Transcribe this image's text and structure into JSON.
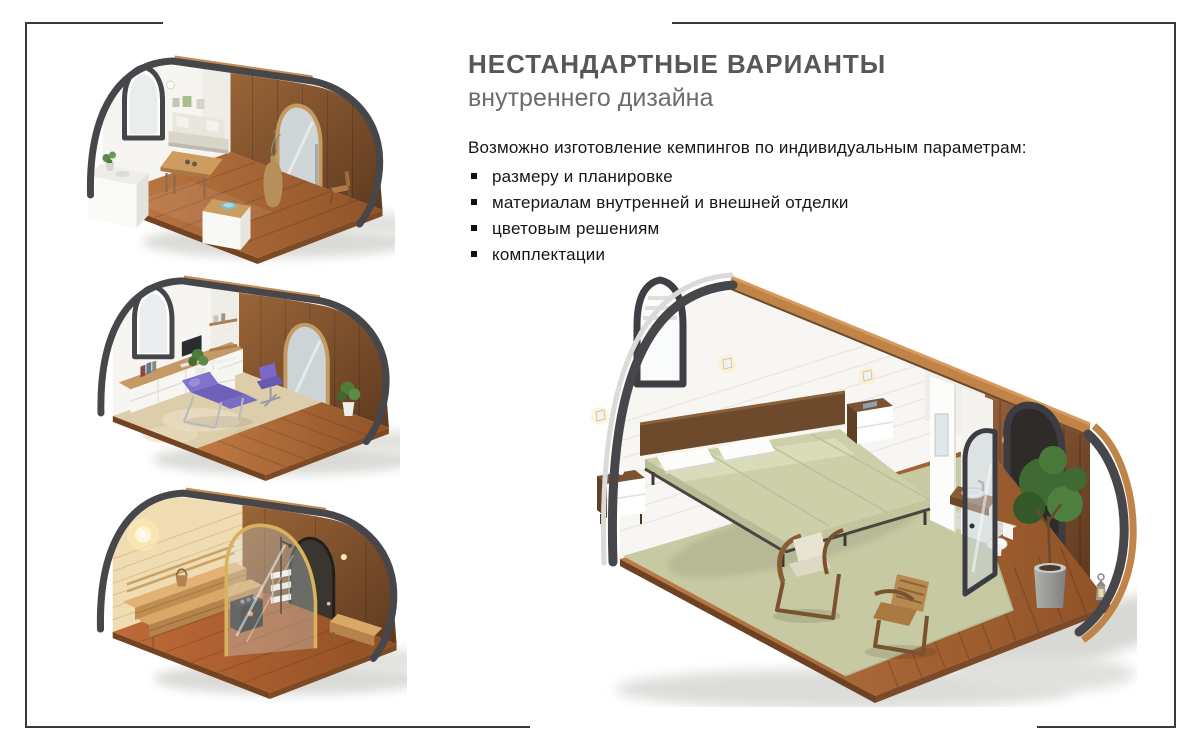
{
  "page": {
    "background": "#ffffff",
    "frame_color": "#3b3b33"
  },
  "header": {
    "title": "НЕСТАНДАРТНЫЕ ВАРИАНТЫ",
    "subtitle": "внутреннего дизайна",
    "title_color": "#57575a",
    "subtitle_color": "#6c6c6f"
  },
  "body": {
    "intro": "Возможно изготовление кемпингов по индивидуальным параметрам:",
    "bullets": [
      "размеру и планировке",
      "материалам внутренней и внешней отделки",
      "цветовым решениям",
      "комплектации"
    ]
  },
  "gallery": {
    "items": [
      {
        "id": "pod-lounge",
        "alt": "Изометрический разрез кемпинга: обеденная зона с диваном, столом и стойкой"
      },
      {
        "id": "pod-massage",
        "alt": "Изометрический разрез кемпинга: массажный кабинет с кушеткой и рабочим местом"
      },
      {
        "id": "pod-sauna",
        "alt": "Изометрический разрез кемпинга: сауна с деревянными полками и печью"
      },
      {
        "id": "pod-bedroom",
        "alt": "Изометрический разрез кемпинга: спальня с кроватью, креслами и санузлом"
      }
    ],
    "palette": {
      "shell_trim": "#46464b",
      "wall_white": "#f6f5f1",
      "floor_wood": "#b5713c",
      "door_wood": "#8a5a36",
      "roof_rim_wood": "#c08448",
      "bedding_sage": "#ccd0a8",
      "carpet_sage": "#c6c9a2",
      "accent_purple": "#7b68c8",
      "sauna_pine": "#ecd4a8"
    }
  }
}
